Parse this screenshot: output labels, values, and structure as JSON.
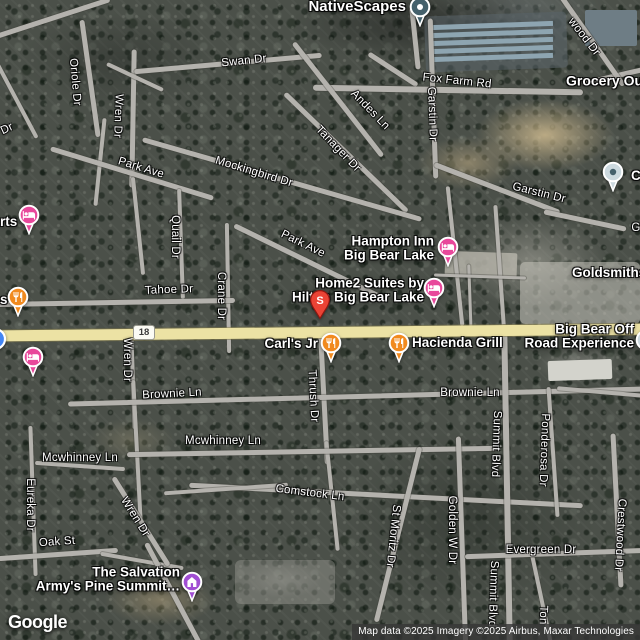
{
  "branding": {
    "logo": "Google"
  },
  "attribution": {
    "text": "Map data ©2025 Imagery ©2025 Airbus, Maxar Technologies"
  },
  "highway_shield": {
    "number": "18"
  },
  "colors": {
    "lodging": "#e8489b",
    "restaurant": "#f18a1f",
    "attraction": "#a14ed3",
    "search_pin": "#ea4335",
    "search_pin_border": "#8f1710",
    "poi_dark": "#44606b",
    "poi_light": "#ccd9df",
    "transit_blue": "#4285f4",
    "highway_road": "#ece2a4",
    "local_road": "#b4b2ad"
  },
  "streets": [
    {
      "label": "Swan Dr",
      "x": 244,
      "y": 61,
      "rot": -6
    },
    {
      "label": "Oriole Dr",
      "x": 75,
      "y": 82,
      "rot": 85
    },
    {
      "label": "Dr",
      "x": 7,
      "y": 129,
      "rot": -25
    },
    {
      "label": "Wren Dr",
      "x": 118,
      "y": 116,
      "rot": 92
    },
    {
      "label": "Park Ave",
      "x": 141,
      "y": 168,
      "rot": 17
    },
    {
      "label": "Mockingbird Dr",
      "x": 254,
      "y": 172,
      "rot": 17
    },
    {
      "label": "Tanager Dr",
      "x": 338,
      "y": 149,
      "rot": 46
    },
    {
      "label": "Andes Ln",
      "x": 370,
      "y": 110,
      "rot": 46
    },
    {
      "label": "wood Dr",
      "x": 584,
      "y": 37,
      "rot": 52
    },
    {
      "label": "Fox Farm Rd",
      "x": 457,
      "y": 81,
      "rot": 6
    },
    {
      "label": "Garstin Dr",
      "x": 432,
      "y": 114,
      "rot": 88
    },
    {
      "label": "Garstin Dr",
      "x": 539,
      "y": 193,
      "rot": 14
    },
    {
      "label": "Quail Dr",
      "x": 175,
      "y": 237,
      "rot": 90
    },
    {
      "label": "Park Ave",
      "x": 303,
      "y": 244,
      "rot": 26
    },
    {
      "label": "Crane Dr",
      "x": 221,
      "y": 296,
      "rot": 90
    },
    {
      "label": "Tahoe Dr",
      "x": 169,
      "y": 290,
      "rot": -2
    },
    {
      "label": "Wren Dr",
      "x": 127,
      "y": 360,
      "rot": 90
    },
    {
      "label": "Brownie Ln",
      "x": 172,
      "y": 394,
      "rot": -3
    },
    {
      "label": "Brownie Ln",
      "x": 470,
      "y": 393,
      "rot": 0
    },
    {
      "label": "Thrush Dr",
      "x": 313,
      "y": 396,
      "rot": 87
    },
    {
      "label": "Mcwhinney Ln",
      "x": 80,
      "y": 458,
      "rot": 0
    },
    {
      "label": "Mcwhinney Ln",
      "x": 223,
      "y": 441,
      "rot": 0
    },
    {
      "label": "Comstock Ln",
      "x": 310,
      "y": 493,
      "rot": 7
    },
    {
      "label": "Eureka Dr",
      "x": 30,
      "y": 505,
      "rot": 90
    },
    {
      "label": "Wren Dr",
      "x": 135,
      "y": 517,
      "rot": 58
    },
    {
      "label": "Oak St",
      "x": 57,
      "y": 542,
      "rot": -4
    },
    {
      "label": "St Moritz Dr",
      "x": 393,
      "y": 536,
      "rot": 96
    },
    {
      "label": "Golden W Dr",
      "x": 452,
      "y": 530,
      "rot": 90
    },
    {
      "label": "Summit Blvd",
      "x": 496,
      "y": 444,
      "rot": 92
    },
    {
      "label": "Ponderosa Dr",
      "x": 544,
      "y": 450,
      "rot": 92
    },
    {
      "label": "Evergreen Dr",
      "x": 541,
      "y": 550,
      "rot": 0
    },
    {
      "label": "Crestwood Dr",
      "x": 620,
      "y": 535,
      "rot": 93
    },
    {
      "label": "Summit Blvd",
      "x": 493,
      "y": 594,
      "rot": 92
    },
    {
      "label": "Ton",
      "x": 543,
      "y": 615,
      "rot": 92
    },
    {
      "label": "G",
      "x": 636,
      "y": 228,
      "rot": 0
    }
  ],
  "pois": [
    {
      "id": "nativescapes",
      "lines": [
        "NativeScapes"
      ],
      "anchor": "right",
      "x": 406,
      "y": 7,
      "size": 15
    },
    {
      "id": "grocery-outlet",
      "lines": [
        "Grocery Outlet"
      ],
      "anchor": "left",
      "x": 566,
      "y": 81,
      "size": 14
    },
    {
      "id": "cl-partial",
      "lines": [
        "Cl"
      ],
      "anchor": "left",
      "x": 631,
      "y": 176,
      "size": 13.5
    },
    {
      "id": "rts-partial",
      "lines": [
        "rts"
      ],
      "anchor": "left",
      "x": 0,
      "y": 222,
      "size": 13.5
    },
    {
      "id": "s-partial",
      "lines": [
        "s"
      ],
      "anchor": "left",
      "x": 0,
      "y": 300,
      "size": 13.5
    },
    {
      "id": "hampton-inn",
      "lines": [
        "Hampton Inn",
        "Big Bear Lake"
      ],
      "anchor": "right",
      "x": 434,
      "y": 249,
      "size": 13.5
    },
    {
      "id": "home2-suites",
      "lines": [
        "Home2 Suites by",
        "Hilton Big Bear Lake"
      ],
      "anchor": "right",
      "x": 424,
      "y": 291,
      "size": 13.5
    },
    {
      "id": "carls-jr",
      "lines": [
        "Carl's Jr"
      ],
      "anchor": "right",
      "x": 318,
      "y": 344,
      "size": 13.5
    },
    {
      "id": "hacienda-grill",
      "lines": [
        "Hacienda Grill"
      ],
      "anchor": "left",
      "x": 412,
      "y": 343,
      "size": 13.5
    },
    {
      "id": "big-bear-off-road",
      "lines": [
        "Big Bear Off",
        "Road Experience"
      ],
      "anchor": "right",
      "x": 634,
      "y": 337,
      "size": 13.5
    },
    {
      "id": "salvation-army",
      "lines": [
        "The Salvation",
        "Army's Pine Summit…"
      ],
      "anchor": "right",
      "x": 180,
      "y": 580,
      "size": 13.5
    },
    {
      "id": "goldsmiths",
      "lines": [
        "Goldsmiths"
      ],
      "anchor": "left",
      "x": 572,
      "y": 273,
      "size": 13.5
    }
  ],
  "markers": [
    {
      "name": "nativescapes-marker",
      "type": "poi-dark",
      "x": 420,
      "y": 7
    },
    {
      "name": "poi-marker-right-top",
      "type": "poi-light",
      "x": 613,
      "y": 172
    },
    {
      "name": "lodging-marker-left-upper",
      "type": "lodging",
      "x": 29,
      "y": 215
    },
    {
      "name": "restaurant-marker-left",
      "type": "restaurant",
      "x": 18,
      "y": 297
    },
    {
      "name": "blue-marker-left-edge",
      "type": "blue-dot",
      "x": -5,
      "y": 339
    },
    {
      "name": "lodging-marker-left-lower",
      "type": "lodging",
      "x": 33,
      "y": 357
    },
    {
      "name": "hampton-inn-marker",
      "type": "lodging",
      "x": 448,
      "y": 247
    },
    {
      "name": "home2-suites-marker",
      "type": "lodging",
      "x": 434,
      "y": 288
    },
    {
      "name": "search-result-pin",
      "type": "search-pin",
      "label": "S",
      "x": 320,
      "y": 300
    },
    {
      "name": "carls-jr-marker",
      "type": "restaurant",
      "x": 331,
      "y": 343
    },
    {
      "name": "hacienda-grill-marker",
      "type": "restaurant",
      "x": 399,
      "y": 343
    },
    {
      "name": "big-bear-off-road-marker",
      "type": "poi-light",
      "x": 646,
      "y": 340
    },
    {
      "name": "salvation-army-marker",
      "type": "attraction",
      "x": 192,
      "y": 582
    }
  ],
  "roads": [
    {
      "cx": 45,
      "cy": 20,
      "len": 135,
      "th": 5,
      "rot": -18
    },
    {
      "cx": 14,
      "cy": 96,
      "len": 95,
      "th": 4,
      "rot": 62
    },
    {
      "cx": 90,
      "cy": 78,
      "len": 118,
      "th": 5,
      "rot": 82
    },
    {
      "cx": 100,
      "cy": 162,
      "len": 88,
      "th": 4,
      "rot": 96
    },
    {
      "cx": 133,
      "cy": 118,
      "len": 138,
      "th": 5,
      "rot": 91
    },
    {
      "cx": 135,
      "cy": 77,
      "len": 62,
      "th": 4,
      "rot": 25
    },
    {
      "cx": 228,
      "cy": 63,
      "len": 188,
      "th": 5,
      "rot": -5
    },
    {
      "cx": 415,
      "cy": 38,
      "len": 62,
      "th": 5,
      "rot": 84
    },
    {
      "cx": 393,
      "cy": 69,
      "len": 58,
      "th": 5,
      "rot": 33
    },
    {
      "cx": 448,
      "cy": 90,
      "len": 270,
      "th": 6,
      "rot": 1
    },
    {
      "cx": 613,
      "cy": 76,
      "len": 64,
      "th": 5,
      "rot": -13
    },
    {
      "cx": 592,
      "cy": 40,
      "len": 110,
      "th": 5,
      "rot": 55
    },
    {
      "cx": 433,
      "cy": 98,
      "len": 160,
      "th": 5,
      "rot": 88
    },
    {
      "cx": 497,
      "cy": 188,
      "len": 134,
      "th": 5,
      "rot": 21
    },
    {
      "cx": 585,
      "cy": 220,
      "len": 84,
      "th": 5,
      "rot": 12
    },
    {
      "cx": 338,
      "cy": 99,
      "len": 144,
      "th": 5,
      "rot": 52
    },
    {
      "cx": 346,
      "cy": 152,
      "len": 170,
      "th": 5,
      "rot": 44
    },
    {
      "cx": 282,
      "cy": 179,
      "len": 290,
      "th": 5,
      "rot": 16
    },
    {
      "cx": 132,
      "cy": 173,
      "len": 170,
      "th": 5,
      "rot": 17
    },
    {
      "cx": 308,
      "cy": 261,
      "len": 164,
      "th": 5,
      "rot": 26
    },
    {
      "cx": 181,
      "cy": 244,
      "len": 110,
      "th": 4,
      "rot": 88
    },
    {
      "cx": 228,
      "cy": 288,
      "len": 130,
      "th": 4,
      "rot": 89
    },
    {
      "cx": 138,
      "cy": 226,
      "len": 98,
      "th": 4,
      "rot": 84
    },
    {
      "cx": 115,
      "cy": 302,
      "len": 240,
      "th": 5,
      "rot": -1
    },
    {
      "cx": 320,
      "cy": 332,
      "len": 658,
      "th": 11,
      "rot": -0.6,
      "k": "hwy"
    },
    {
      "cx": 455,
      "cy": 256,
      "len": 140,
      "th": 4,
      "rot": 84
    },
    {
      "cx": 500,
      "cy": 272,
      "len": 134,
      "th": 4,
      "rot": 86
    },
    {
      "cx": 470,
      "cy": 300,
      "len": 72,
      "th": 3,
      "rot": 88
    },
    {
      "cx": 480,
      "cy": 276,
      "len": 92,
      "th": 3,
      "rot": 2
    },
    {
      "cx": 133,
      "cy": 382,
      "len": 94,
      "th": 4,
      "rot": 88
    },
    {
      "cx": 137,
      "cy": 452,
      "len": 144,
      "th": 4,
      "rot": 87
    },
    {
      "cx": 324,
      "cy": 399,
      "len": 130,
      "th": 5,
      "rot": 87
    },
    {
      "cx": 332,
      "cy": 496,
      "len": 110,
      "th": 4,
      "rot": 84
    },
    {
      "cx": 357,
      "cy": 396,
      "len": 578,
      "th": 5,
      "rot": -1.5
    },
    {
      "cx": 80,
      "cy": 466,
      "len": 90,
      "th": 4,
      "rot": 4
    },
    {
      "cx": 312,
      "cy": 451,
      "len": 370,
      "th": 5,
      "rot": -1
    },
    {
      "cx": 386,
      "cy": 495,
      "len": 394,
      "th": 5,
      "rot": 3
    },
    {
      "cx": 226,
      "cy": 489,
      "len": 124,
      "th": 4,
      "rot": -4
    },
    {
      "cx": 33,
      "cy": 501,
      "len": 150,
      "th": 4,
      "rot": 88
    },
    {
      "cx": 58,
      "cy": 554,
      "len": 120,
      "th": 5,
      "rot": -4
    },
    {
      "cx": 142,
      "cy": 561,
      "len": 84,
      "th": 4,
      "rot": 10
    },
    {
      "cx": 141,
      "cy": 521,
      "len": 104,
      "th": 5,
      "rot": 58
    },
    {
      "cx": 173,
      "cy": 593,
      "len": 114,
      "th": 5,
      "rot": 62
    },
    {
      "cx": 398,
      "cy": 534,
      "len": 180,
      "th": 5,
      "rot": 104
    },
    {
      "cx": 462,
      "cy": 541,
      "len": 210,
      "th": 5,
      "rot": 88
    },
    {
      "cx": 507,
      "cy": 487,
      "len": 324,
      "th": 6,
      "rot": 89
    },
    {
      "cx": 553,
      "cy": 452,
      "len": 130,
      "th": 4,
      "rot": 86
    },
    {
      "cx": 541,
      "cy": 597,
      "len": 104,
      "th": 4,
      "rot": 78
    },
    {
      "cx": 557,
      "cy": 553,
      "len": 184,
      "th": 5,
      "rot": -2
    },
    {
      "cx": 617,
      "cy": 510,
      "len": 154,
      "th": 5,
      "rot": 87
    },
    {
      "cx": 600,
      "cy": 392,
      "len": 86,
      "th": 4,
      "rot": 5
    }
  ]
}
